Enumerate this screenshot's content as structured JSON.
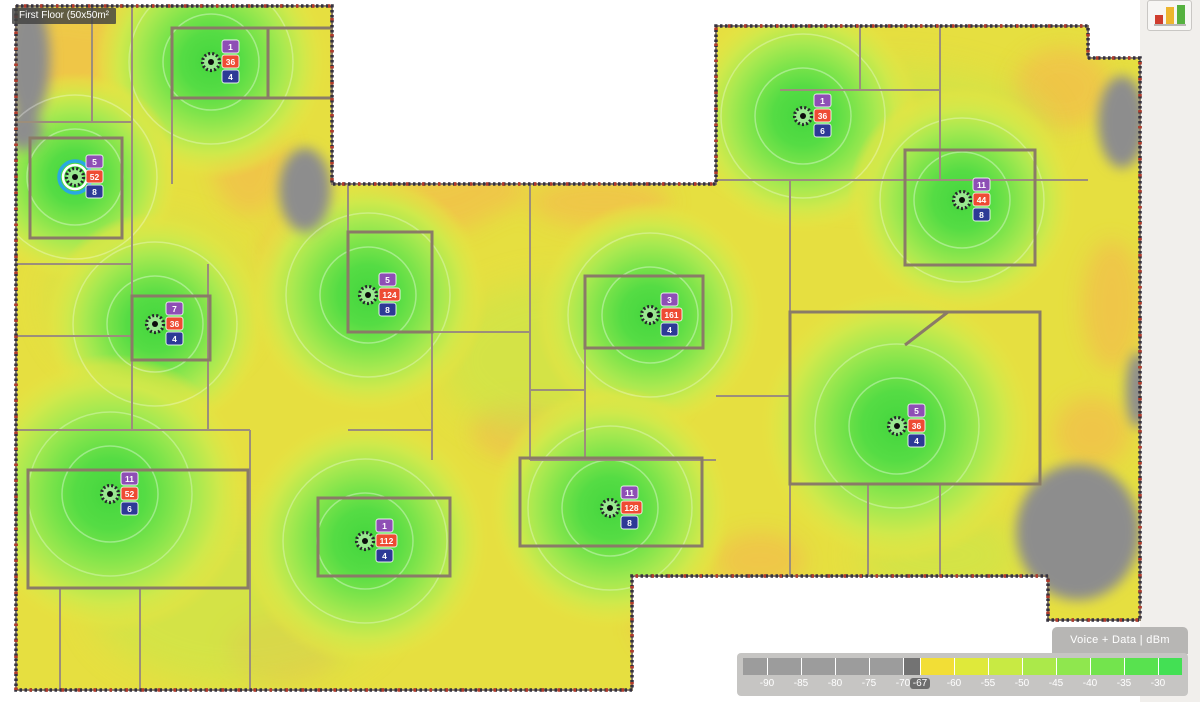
{
  "app": {
    "floor_label": "First Floor (50x50m²"
  },
  "legend": {
    "title": "Voice + Data  |  dBm",
    "unit": "dBm",
    "visualization": "Voice + Data",
    "selected_threshold": "-67",
    "segments": [
      {
        "w": 24,
        "color": "#9c9c9c"
      },
      {
        "w": 34,
        "color": "#9c9c9c"
      },
      {
        "w": 34,
        "color": "#9c9c9c"
      },
      {
        "w": 34,
        "color": "#9c9c9c"
      },
      {
        "w": 34,
        "color": "#9c9c9c"
      },
      {
        "w": 17,
        "color": "#737373"
      },
      {
        "w": 34,
        "color": "#f2de36"
      },
      {
        "w": 34,
        "color": "#dfe93a"
      },
      {
        "w": 34,
        "color": "#c8ea43"
      },
      {
        "w": 34,
        "color": "#abe94a"
      },
      {
        "w": 34,
        "color": "#8fe74e"
      },
      {
        "w": 34,
        "color": "#73e44d"
      },
      {
        "w": 34,
        "color": "#58e24f"
      },
      {
        "w": 24,
        "color": "#43e054"
      }
    ],
    "ticks": [
      {
        "label": "-90"
      },
      {
        "label": "-85"
      },
      {
        "label": "-80"
      },
      {
        "label": "-75"
      },
      {
        "label": "-70"
      },
      {
        "label": "-67",
        "selected": true
      },
      {
        "label": "-60"
      },
      {
        "label": "-55"
      },
      {
        "label": "-50"
      },
      {
        "label": "-45"
      },
      {
        "label": "-40"
      },
      {
        "label": "-35"
      },
      {
        "label": "-30"
      }
    ]
  },
  "badge_colors": {
    "band_6ghz": "#8e4fb5",
    "band_5ghz": "#ee4b33",
    "band_24ghz": "#2d3a96"
  },
  "access_points": [
    {
      "id": "ap-1",
      "x": 211,
      "y": 62,
      "selected": false,
      "channels": [
        "1",
        "36",
        "4"
      ],
      "glow": 118
    },
    {
      "id": "ap-2",
      "x": 75,
      "y": 177,
      "selected": true,
      "channels": [
        "5",
        "52",
        "8"
      ],
      "glow": 105
    },
    {
      "id": "ap-3",
      "x": 155,
      "y": 324,
      "selected": false,
      "channels": [
        "7",
        "36",
        "4"
      ],
      "glow": 112
    },
    {
      "id": "ap-4",
      "x": 368,
      "y": 295,
      "selected": false,
      "channels": [
        "5",
        "124",
        "8"
      ],
      "glow": 120
    },
    {
      "id": "ap-5",
      "x": 650,
      "y": 315,
      "selected": false,
      "channels": [
        "3",
        "161",
        "4"
      ],
      "glow": 115
    },
    {
      "id": "ap-6",
      "x": 803,
      "y": 116,
      "selected": false,
      "channels": [
        "1",
        "36",
        "6"
      ],
      "glow": 118
    },
    {
      "id": "ap-7",
      "x": 962,
      "y": 200,
      "selected": false,
      "channels": [
        "11",
        "44",
        "8"
      ],
      "glow": 115
    },
    {
      "id": "ap-8",
      "x": 897,
      "y": 426,
      "selected": false,
      "channels": [
        "5",
        "36",
        "4"
      ],
      "glow": 138
    },
    {
      "id": "ap-9",
      "x": 110,
      "y": 494,
      "selected": false,
      "channels": [
        "11",
        "52",
        "6"
      ],
      "glow": 140
    },
    {
      "id": "ap-10",
      "x": 365,
      "y": 541,
      "selected": false,
      "channels": [
        "1",
        "112",
        "4"
      ],
      "glow": 125
    },
    {
      "id": "ap-11",
      "x": 610,
      "y": 508,
      "selected": false,
      "channels": [
        "11",
        "128",
        "8"
      ],
      "glow": 122
    }
  ],
  "heat_colors": {
    "base_yellow": "#e6df40",
    "orange": "#f0c449",
    "green_core": "#44d63e",
    "green_wash": "#c6e74b",
    "no_signal_gray": "#8d8d8d",
    "wall": "#9c8e7b",
    "wall_thick": "#8a7b67",
    "boundary_dark": "#35323f",
    "boundary_red": "#b13a2b",
    "selection_ring": "#29a8e2"
  }
}
